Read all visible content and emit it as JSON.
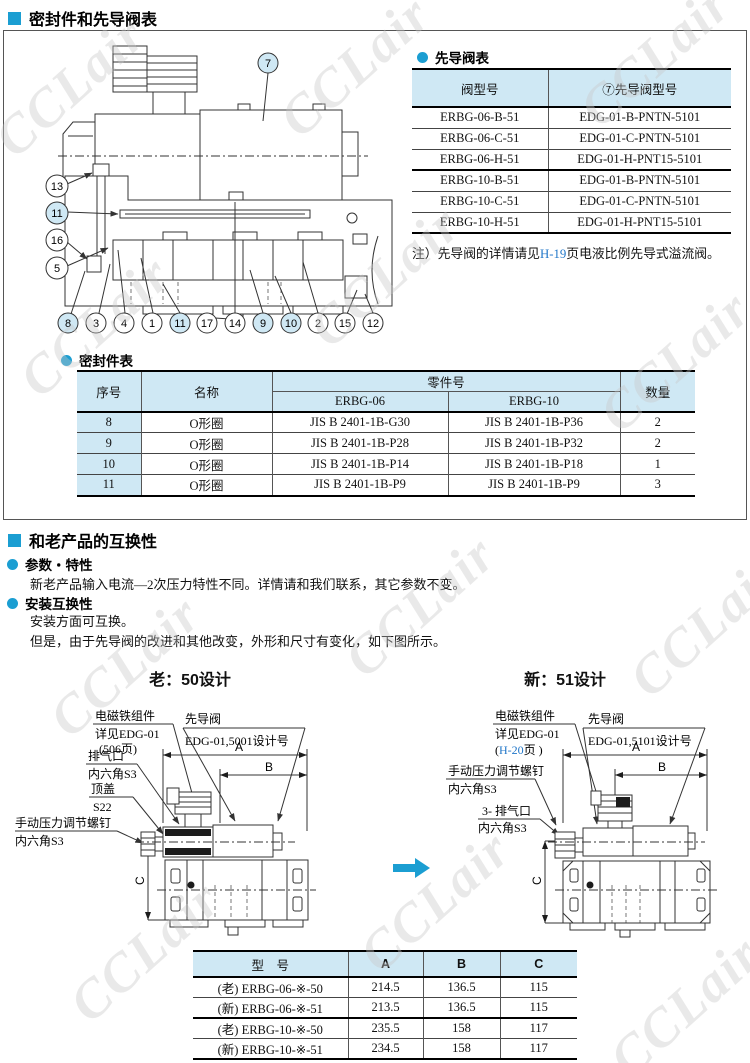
{
  "section1_title": "密封件和先导阀表",
  "section2_title": "和老产品的互换性",
  "watermark": "CCLair",
  "colors": {
    "accent": "#1b9ed2",
    "table_header_bg": "#cfe8f4",
    "link": "#2076c8"
  },
  "pilot_table": {
    "title": "先导阀表",
    "col1": "阀型号",
    "col2": "⑦先导阀型号",
    "rows": [
      [
        "ERBG-06-B-51",
        "EDG-01-B-PNTN-5101"
      ],
      [
        "ERBG-06-C-51",
        "EDG-01-C-PNTN-5101"
      ],
      [
        "ERBG-06-H-51",
        "EDG-01-H-PNT15-5101"
      ],
      [
        "ERBG-10-B-51",
        "EDG-01-B-PNTN-5101"
      ],
      [
        "ERBG-10-C-51",
        "EDG-01-C-PNTN-5101"
      ],
      [
        "ERBG-10-H-51",
        "EDG-01-H-PNT15-5101"
      ]
    ],
    "note_prefix": "注）先导阀的详情请见",
    "note_link": "H-19",
    "note_suffix": "页电液比例先导式溢流阀。"
  },
  "seal_table": {
    "title": "密封件表",
    "col_no": "序号",
    "col_name": "名称",
    "col_part": "零件号",
    "col_erbg06": "ERBG-06",
    "col_erbg10": "ERBG-10",
    "col_qty": "数量",
    "rows": [
      {
        "no": "8",
        "name": "O形圈",
        "p06": "JIS B 2401-1B-G30",
        "p10": "JIS B 2401-1B-P36",
        "qty": "2"
      },
      {
        "no": "9",
        "name": "O形圈",
        "p06": "JIS B 2401-1B-P28",
        "p10": "JIS B 2401-1B-P32",
        "qty": "2"
      },
      {
        "no": "10",
        "name": "O形圈",
        "p06": "JIS B 2401-1B-P14",
        "p10": "JIS B 2401-1B-P18",
        "qty": "1"
      },
      {
        "no": "11",
        "name": "O形圈",
        "p06": "JIS B 2401-1B-P9",
        "p10": "JIS B 2401-1B-P9",
        "qty": "3"
      }
    ]
  },
  "diagram": {
    "callouts": [
      "7",
      "13",
      "11",
      "16",
      "5",
      "8",
      "3",
      "4",
      "1",
      "11",
      "17",
      "14",
      "9",
      "10",
      "2",
      "15",
      "12"
    ]
  },
  "compat": {
    "b1": "参数・特性",
    "p1": "新老产品输入电流—2次压力特性不同。详情请和我们联系，其它参数不变。",
    "b2": "安装互换性",
    "p2": "安装方面可互换。",
    "p3": "但是，由于先导阀的改进和其他改变，外形和尺寸有变化，如下图所示。"
  },
  "old_design": {
    "title": "老：50设计",
    "solenoid_label_1": "电磁铁组件",
    "solenoid_label_2": "详见EDG-01",
    "solenoid_label_3": "(506页)",
    "pilot_label_1": "先导阀",
    "pilot_label_2": "EDG-01,5001设计号",
    "vent_label_1": "排气口",
    "vent_label_2": "内六角S3",
    "cap_label_1": "顶盖",
    "cap_label_2": "S22",
    "manual_label_1": "手动压力调节螺钉",
    "manual_label_2": "内六角S3",
    "dim_a": "A",
    "dim_b": "B",
    "dim_c": "C"
  },
  "new_design": {
    "title": "新：51设计",
    "solenoid_label_1": "电磁铁组件",
    "solenoid_label_2": "详见EDG-01",
    "solenoid_label_3_pre": "(",
    "solenoid_label_3_link": "H-20",
    "solenoid_label_3_suf": "页 )",
    "pilot_label_1": "先导阀",
    "pilot_label_2": "EDG-01,5101设计号",
    "manual_label_1": "手动压力调节螺钉",
    "manual_label_2": "内六角S3",
    "vent_label_1": "3- 排气口",
    "vent_label_2": "内六角S3",
    "dim_a": "A",
    "dim_b": "B",
    "dim_c": "C"
  },
  "dim_table": {
    "col_model": "型　号",
    "col_a": "A",
    "col_b": "B",
    "col_c": "C",
    "rows": [
      [
        "(老) ERBG-06-※-50",
        "214.5",
        "136.5",
        "115"
      ],
      [
        "(新) ERBG-06-※-51",
        "213.5",
        "136.5",
        "115"
      ],
      [
        "(老) ERBG-10-※-50",
        "235.5",
        "158",
        "117"
      ],
      [
        "(新) ERBG-10-※-51",
        "234.5",
        "158",
        "117"
      ]
    ]
  }
}
